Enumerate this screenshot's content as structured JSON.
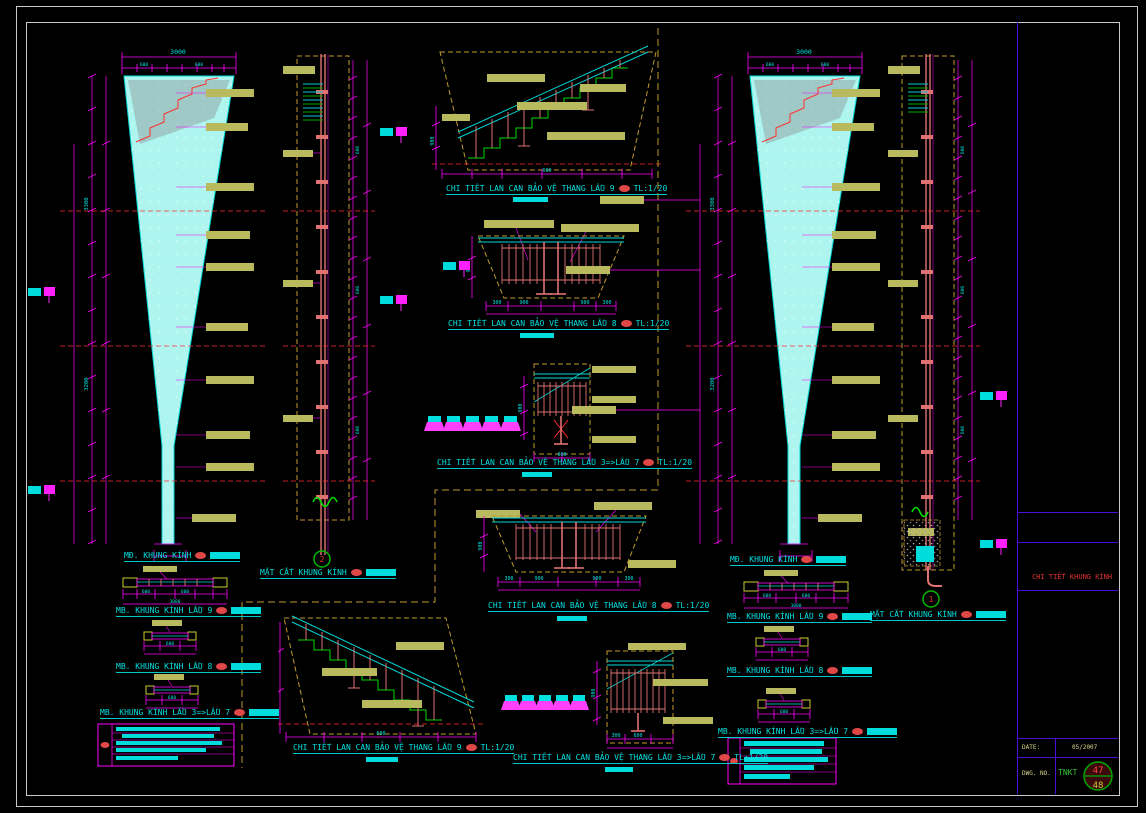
{
  "drawing": {
    "left": {
      "elevation_label": "MĐ. KHUNG KÍNH",
      "plan_labels": [
        "MB. KHUNG KÍNH LẦU 9",
        "MB. KHUNG KÍNH LẦU 8",
        "MB. KHUNG KÍNH LẦU 3=>LẦU 7"
      ],
      "section_label": "MẶT CẮT KHUNG KÍNH",
      "section_mark": "2"
    },
    "right": {
      "elevation_label": "MĐ. KHUNG KÍNH",
      "plan_labels": [
        "MB. KHUNG KÍNH LẦU 9",
        "MB. KHUNG KÍNH LẦU 8",
        "MB. KHUNG KÍNH LẦU 3=>LẦU 7"
      ],
      "section_label": "MẶT CẮT KHUNG KÍNH",
      "section_mark": "1"
    },
    "details": [
      {
        "label": "CHI TIẾT LAN CAN BẢO VỆ THANG LẦU 9",
        "scale": "TL:1/20"
      },
      {
        "label": "CHI TIẾT LAN CAN BẢO VỆ THANG LẦU 8",
        "scale": "TL:1/20"
      },
      {
        "label": "CHI TIẾT LAN CAN BẢO VỆ THANG LẦU 3=>LẦU 7",
        "scale": "TL:1/20"
      },
      {
        "label": "CHI TIẾT LAN CAN BẢO VỆ THANG LẦU 8",
        "scale": "TL:1/20"
      },
      {
        "label": "CHI TIẾT LAN CAN BẢO VỆ THANG LẦU 9",
        "scale": "TL:1/20"
      },
      {
        "label": "CHI TIẾT LAN CAN BẢO VỆ THANG LẦU 3=>LẦU 7",
        "scale": "TL:1/20"
      }
    ],
    "dims": {
      "w3000": "3000",
      "seg600": "600",
      "d900": "900",
      "d300": "300",
      "h3300": "3300",
      "h3200": "3200"
    }
  },
  "title_block": {
    "side_title": "CHI TIẾT KHUNG KÍNH",
    "date_label": "DATE:",
    "date_value": "05/2007",
    "dwg_label": "DWG. NO.",
    "company": "TNKT",
    "sheet_top": "47",
    "sheet_bottom": "48"
  },
  "colors": {
    "background": "#000000",
    "frame": "#c9c9c9",
    "magenta": "#ff00ff",
    "cyan": "#00e0e0",
    "red": "#ff3030",
    "salmon": "#e07272",
    "khaki": "#b9b95e",
    "green": "#00d800",
    "dash_gold": "#c09a2e",
    "divider_purple": "#4a10d8",
    "glass_fill": "#aef4ef"
  }
}
